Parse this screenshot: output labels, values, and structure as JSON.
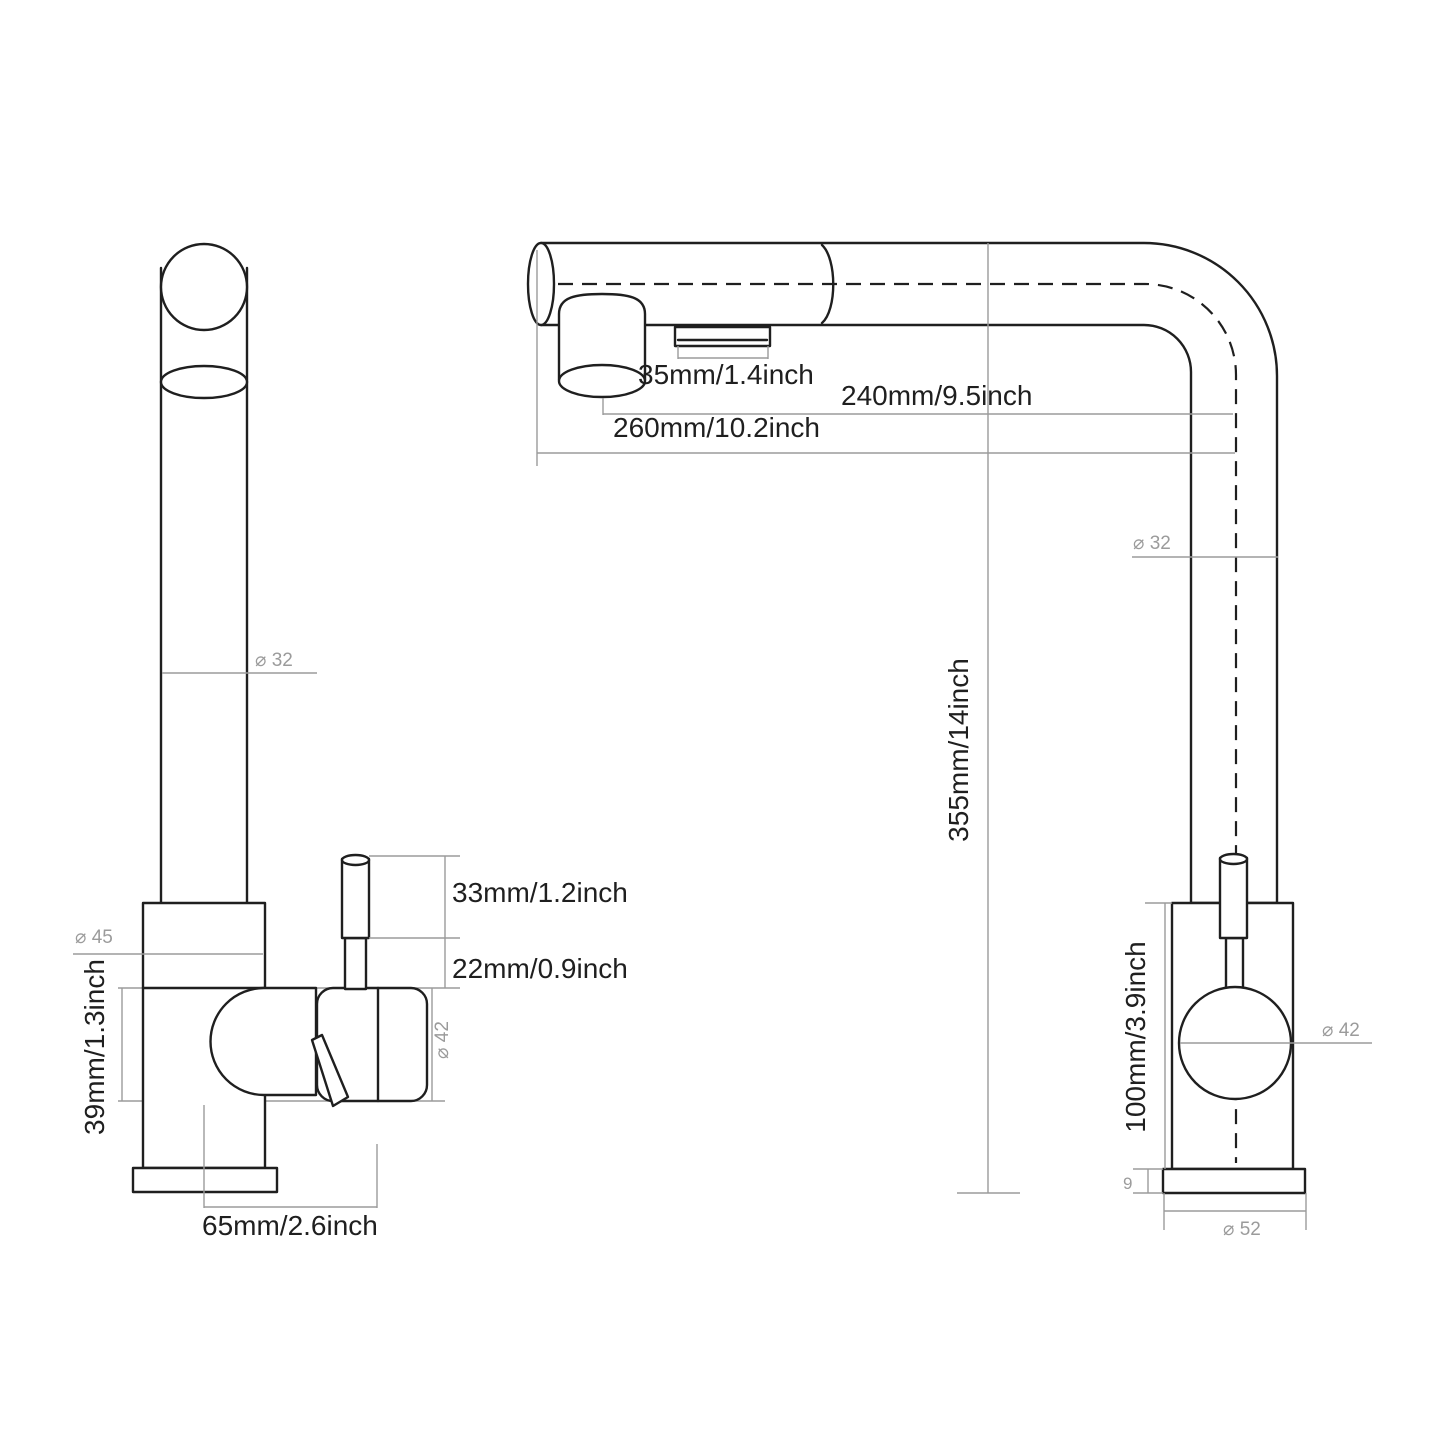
{
  "drawing": {
    "type": "faucet-dimension-diagram",
    "background_color": "#ffffff",
    "outline_color": "#1f1f1f",
    "dimension_color": "#9b9b9b",
    "views": [
      "side-profile-view",
      "front-view"
    ]
  },
  "dimensions": {
    "spray_button_width": "35mm/1.4inch",
    "spout_reach_to_center": "240mm/9.5inch",
    "spout_reach_total": "260mm/10.2inch",
    "spout_height": "355mm/14inch",
    "spout_diameter_side": "⌀ 32",
    "spout_diameter_front": "⌀ 32",
    "handle_grip_length": "33mm/1.2inch",
    "handle_stem_length": "22mm/0.9inch",
    "collar_diameter": "⌀ 45",
    "valve_body_height": "39mm/1.3inch",
    "cartridge_diameter_side": "⌀ 42",
    "cartridge_diameter_front": "⌀ 42",
    "handle_offset": "65mm/2.6inch",
    "body_height": "100mm/3.9inch",
    "base_plate_thickness": "9",
    "base_plate_diameter": "⌀ 52"
  }
}
